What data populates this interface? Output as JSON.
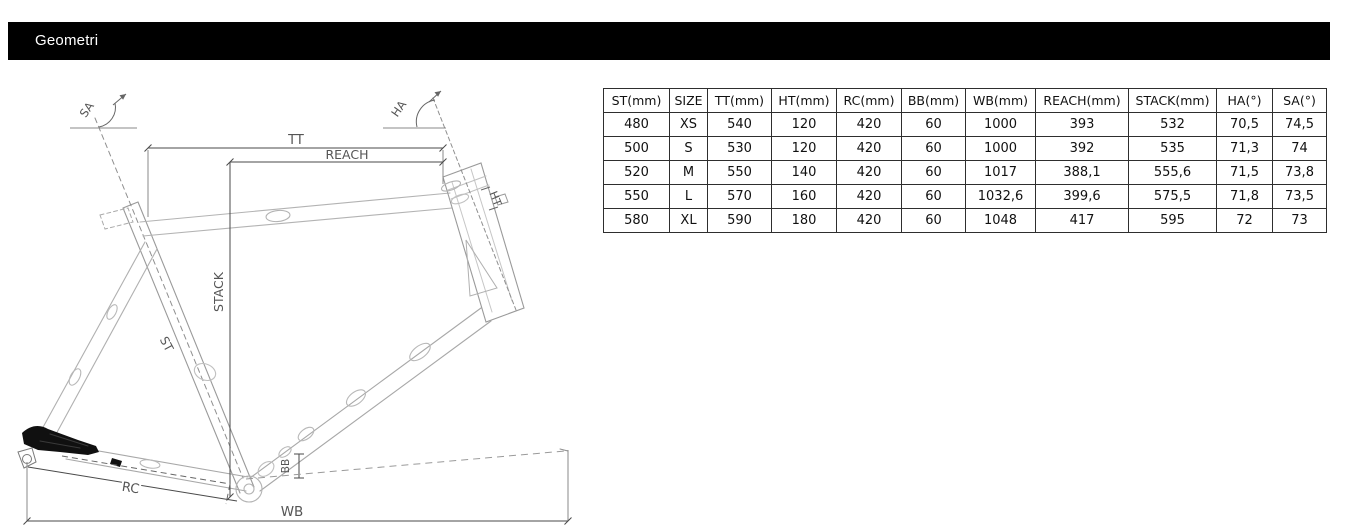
{
  "header": {
    "title": "Geometri"
  },
  "table": {
    "columns": [
      "ST(mm)",
      "SIZE",
      "TT(mm)",
      "HT(mm)",
      "RC(mm)",
      "BB(mm)",
      "WB(mm)",
      "REACH(mm)",
      "STACK(mm)",
      "HA(°)",
      "SA(°)"
    ],
    "rows": [
      [
        "480",
        "XS",
        "540",
        "120",
        "420",
        "60",
        "1000",
        "393",
        "532",
        "70,5",
        "74,5"
      ],
      [
        "500",
        "S",
        "530",
        "120",
        "420",
        "60",
        "1000",
        "392",
        "535",
        "71,3",
        "74"
      ],
      [
        "520",
        "M",
        "550",
        "140",
        "420",
        "60",
        "1017",
        "388,1",
        "555,6",
        "71,5",
        "73,8"
      ],
      [
        "550",
        "L",
        "570",
        "160",
        "420",
        "60",
        "1032,6",
        "399,6",
        "575,5",
        "71,8",
        "73,5"
      ],
      [
        "580",
        "XL",
        "590",
        "180",
        "420",
        "60",
        "1048",
        "417",
        "595",
        "72",
        "73"
      ]
    ]
  },
  "diagram": {
    "labels": {
      "tt": "TT",
      "reach": "REACH",
      "stack": "STACK",
      "st": "ST",
      "ht": "HT",
      "bb": "BB",
      "rc": "RC",
      "wb": "WB",
      "sa": "SA",
      "ha": "HA"
    }
  },
  "colors": {
    "header_bg": "#000000",
    "header_text": "#ffffff",
    "table_border": "#2e2e2e",
    "drawing_line": "#a9a9a9",
    "dimension_line": "#4a4a4a",
    "label_text": "#555555"
  }
}
